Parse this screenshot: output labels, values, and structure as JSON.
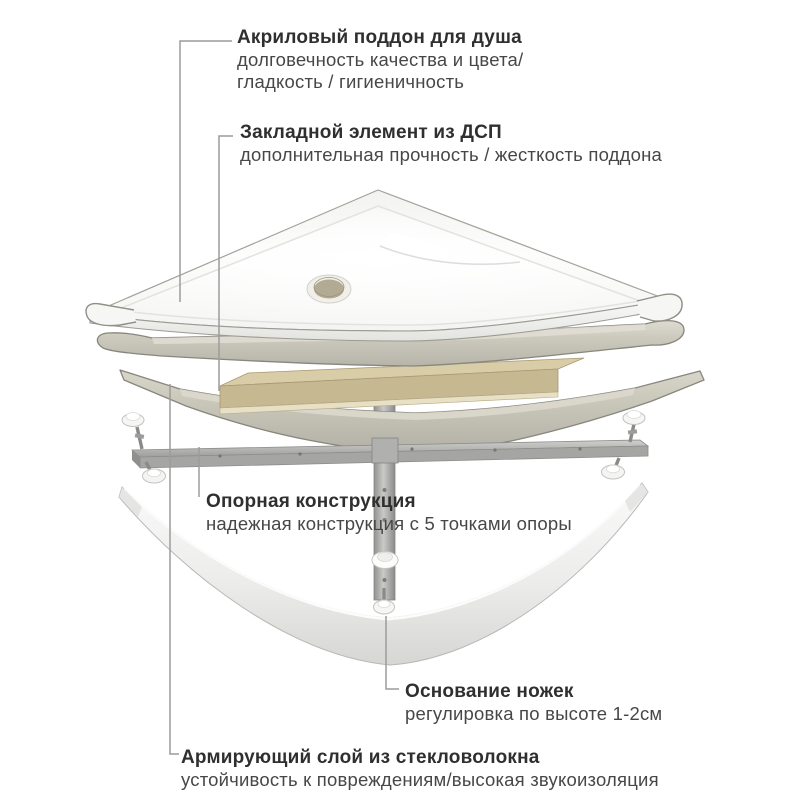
{
  "colors": {
    "background": "#ffffff",
    "title_text": "#2f2f2f",
    "body_text": "#474747",
    "connector_line": "#9c9c9c",
    "acrylic_white": "#fbfbfa",
    "fiberglass_gray": "#c9c6ba",
    "chipboard_tan": "#c6b890",
    "metal_gray": "#b1b1af",
    "apron_white": "#ededec"
  },
  "annotations": [
    {
      "id": "acrylic-tray",
      "title": "Акриловый поддон для душа",
      "lines": [
        "долговечность качества и цвета/",
        "гладкость / гигиеничность"
      ]
    },
    {
      "id": "chipboard-insert",
      "title": "Закладной элемент из ДСП",
      "lines": [
        "дополнительная прочность / жесткость поддона"
      ]
    },
    {
      "id": "support-frame",
      "title": "Опорная конструкция",
      "lines": [
        "надежная конструкция с 5 точками опоры"
      ]
    },
    {
      "id": "feet-base",
      "title": "Основание ножек",
      "lines": [
        "регулировка по высоте 1-2см"
      ]
    },
    {
      "id": "fiberglass-layer",
      "title": "Армирующий слой из стекловолокна",
      "lines": [
        "устойчивость к повреждениям/высокая звукоизоляция"
      ]
    }
  ]
}
